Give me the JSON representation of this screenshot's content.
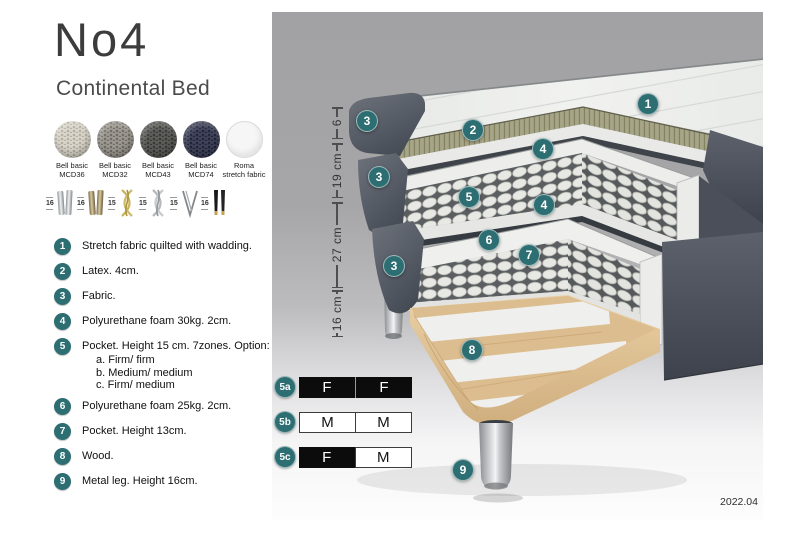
{
  "header": {
    "title": "No4",
    "subtitle": "Continental Bed"
  },
  "fabrics": {
    "items": [
      {
        "line1": "Bell basic",
        "line2": "MCD36"
      },
      {
        "line1": "Bell basic",
        "line2": "MCD32"
      },
      {
        "line1": "Bell basic",
        "line2": "MCD43"
      },
      {
        "line1": "Bell basic",
        "line2": "MCD74"
      },
      {
        "line1": "Roma",
        "line2": "stretch fabric"
      }
    ]
  },
  "legs": {
    "items": [
      {
        "height": "16",
        "name": "chrome cylinder legs"
      },
      {
        "height": "16",
        "name": "brass cylinder legs"
      },
      {
        "height": "15",
        "name": "gold twisted legs"
      },
      {
        "height": "15",
        "name": "silver twisted legs"
      },
      {
        "height": "15",
        "name": "hairpin leg"
      },
      {
        "height": "16",
        "name": "black tapered legs"
      }
    ]
  },
  "specs": {
    "items": [
      {
        "num": "1",
        "text": "Stretch fabric quilted with wadding."
      },
      {
        "num": "2",
        "text": "Latex. 4cm."
      },
      {
        "num": "3",
        "text": "Fabric."
      },
      {
        "num": "4",
        "text": "Polyurethane foam 30kg. 2cm."
      },
      {
        "num": "5",
        "text": "Pocket. Height 15 cm. 7zones. Option:",
        "options": [
          "a. Firm/ firm",
          "b. Medium/ medium",
          "c. Firm/ medium"
        ]
      },
      {
        "num": "6",
        "text": "Polyurethane foam 25kg. 2cm."
      },
      {
        "num": "7",
        "text": "Pocket. Height 13cm."
      },
      {
        "num": "8",
        "text": "Wood."
      },
      {
        "num": "9",
        "text": "Metal leg. Height 16cm."
      }
    ]
  },
  "diagram": {
    "accent_color": "#2d6e72",
    "badges": [
      {
        "n": "1"
      },
      {
        "n": "2"
      },
      {
        "n": "3"
      },
      {
        "n": "4"
      },
      {
        "n": "3"
      },
      {
        "n": "5"
      },
      {
        "n": "4"
      },
      {
        "n": "6"
      },
      {
        "n": "7"
      },
      {
        "n": "3"
      },
      {
        "n": "8"
      },
      {
        "n": "9"
      }
    ],
    "dimensions": [
      {
        "label": "6"
      },
      {
        "label": "19 cm"
      },
      {
        "label": "27 cm"
      },
      {
        "label": "16 cm"
      }
    ],
    "firmness": [
      {
        "id": "5a",
        "cells": [
          {
            "label": "F"
          },
          {
            "label": "F"
          }
        ]
      },
      {
        "id": "5b",
        "cells": [
          {
            "label": "M"
          },
          {
            "label": "M"
          }
        ]
      },
      {
        "id": "5c",
        "cells": [
          {
            "label": "F"
          },
          {
            "label": "M"
          }
        ]
      }
    ],
    "version": "2022.04"
  }
}
